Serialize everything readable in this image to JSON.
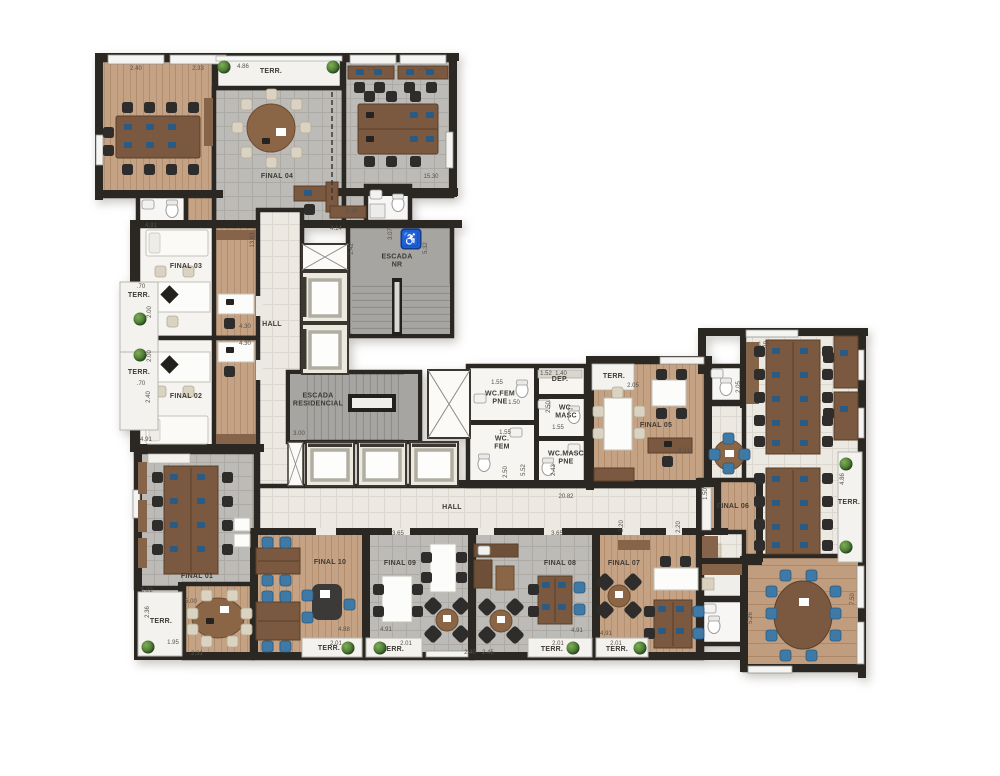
{
  "floor_plan": {
    "colors": {
      "wall": "#2b2824",
      "wood_floor": "#c4a283",
      "stone_floor": "#bdbbb7",
      "hall_floor": "#ebe9e2",
      "stair_floor": "#a6a5a2",
      "terrace_floor": "#f3f2ee",
      "desk_wood": "#7b5941",
      "chair_dark": "#2e2d2c",
      "chair_blue": "#3f79a5",
      "chair_beige": "#dbd3c2",
      "accessibility_blue": "#1d5ed2"
    },
    "accessibility_icon": {
      "symbol": "♿",
      "x": 411,
      "y": 239
    },
    "unit_labels": [
      {
        "id": "terr-top",
        "text": "TERR.",
        "x": 271,
        "y": 72
      },
      {
        "id": "final-04",
        "text": "FINAL 04",
        "x": 277,
        "y": 177
      },
      {
        "id": "final-03",
        "text": "FINAL 03",
        "x": 186,
        "y": 267
      },
      {
        "id": "terr-left-1",
        "text": "TERR.",
        "x": 139,
        "y": 296
      },
      {
        "id": "terr-left-2",
        "text": "TERR.",
        "x": 139,
        "y": 373
      },
      {
        "id": "final-02",
        "text": "FINAL 02",
        "x": 186,
        "y": 397
      },
      {
        "id": "hall-vertical",
        "text": "HALL",
        "x": 272,
        "y": 325
      },
      {
        "id": "escada-nr",
        "text": "ESCADA\nNR",
        "x": 397,
        "y": 262
      },
      {
        "id": "escada-residencial",
        "text": "ESCADA\nRESIDENCIAL",
        "x": 318,
        "y": 401
      },
      {
        "id": "dep",
        "text": "DEP.",
        "x": 560,
        "y": 380
      },
      {
        "id": "wc-fem-pne",
        "text": "WC.FEM\nPNE",
        "x": 500,
        "y": 399
      },
      {
        "id": "wc-masc",
        "text": "WC.\nMASC",
        "x": 566,
        "y": 413
      },
      {
        "id": "wc-fem",
        "text": "WC.\nFEM",
        "x": 502,
        "y": 444
      },
      {
        "id": "wc-masc-pne",
        "text": "WC.MASC\nPNE",
        "x": 566,
        "y": 459
      },
      {
        "id": "terr-05",
        "text": "TERR.",
        "x": 614,
        "y": 377
      },
      {
        "id": "final-05",
        "text": "FINAL 05",
        "x": 656,
        "y": 426
      },
      {
        "id": "hall-horizontal",
        "text": "HALL",
        "x": 452,
        "y": 508
      },
      {
        "id": "final-06",
        "text": "FINAL 06",
        "x": 733,
        "y": 507
      },
      {
        "id": "terr-06",
        "text": "TERR.",
        "x": 849,
        "y": 503
      },
      {
        "id": "final-01",
        "text": "FINAL 01",
        "x": 197,
        "y": 577
      },
      {
        "id": "terr-01",
        "text": "TERR.",
        "x": 161,
        "y": 622
      },
      {
        "id": "final-10",
        "text": "FINAL 10",
        "x": 330,
        "y": 563
      },
      {
        "id": "terr-10",
        "text": "TERR.",
        "x": 329,
        "y": 649
      },
      {
        "id": "final-09",
        "text": "FINAL 09",
        "x": 400,
        "y": 564
      },
      {
        "id": "terr-09",
        "text": "TERR.",
        "x": 393,
        "y": 650
      },
      {
        "id": "final-08",
        "text": "FINAL 08",
        "x": 560,
        "y": 564
      },
      {
        "id": "terr-08",
        "text": "TERR.",
        "x": 552,
        "y": 650
      },
      {
        "id": "final-07",
        "text": "FINAL 07",
        "x": 624,
        "y": 564
      },
      {
        "id": "terr-07",
        "text": "TERR.",
        "x": 617,
        "y": 650
      }
    ],
    "dimensions": [
      {
        "t": "2.40",
        "x": 136,
        "y": 69
      },
      {
        "t": "2.33",
        "x": 198,
        "y": 69
      },
      {
        "t": "4.86",
        "x": 243,
        "y": 67
      },
      {
        "t": "2.51",
        "x": 373,
        "y": 69
      },
      {
        "t": "2.40",
        "x": 424,
        "y": 69
      },
      {
        "t": "15.30",
        "x": 431,
        "y": 177
      },
      {
        "t": "4.91",
        "x": 151,
        "y": 226
      },
      {
        "t": "5.36",
        "x": 352,
        "y": 212
      },
      {
        "t": "4.14",
        "x": 336,
        "y": 229
      },
      {
        "t": "13.63",
        "x": 253,
        "y": 240,
        "v": true
      },
      {
        "t": "1.42",
        "x": 352,
        "y": 249,
        "v": true
      },
      {
        "t": "3.07",
        "x": 391,
        "y": 234,
        "v": true
      },
      {
        "t": "5.32",
        "x": 426,
        "y": 248,
        "v": true
      },
      {
        "t": "4.30",
        "x": 245,
        "y": 327
      },
      {
        "t": "4.30",
        "x": 245,
        "y": 344
      },
      {
        "t": ".70",
        "x": 141,
        "y": 287
      },
      {
        "t": "2.00",
        "x": 150,
        "y": 312,
        "v": true
      },
      {
        "t": "2.00",
        "x": 150,
        "y": 356,
        "v": true
      },
      {
        "t": ".70",
        "x": 141,
        "y": 384
      },
      {
        "t": "2.40",
        "x": 149,
        "y": 397,
        "v": true
      },
      {
        "t": "4.91",
        "x": 146,
        "y": 440
      },
      {
        "t": "3.00",
        "x": 299,
        "y": 434
      },
      {
        "t": "1.55",
        "x": 497,
        "y": 383
      },
      {
        "t": "1.52",
        "x": 546,
        "y": 374
      },
      {
        "t": "1.40",
        "x": 561,
        "y": 374
      },
      {
        "t": "1.50",
        "x": 514,
        "y": 403
      },
      {
        "t": "2.50",
        "x": 549,
        "y": 407,
        "v": true
      },
      {
        "t": "1.55",
        "x": 505,
        "y": 433
      },
      {
        "t": "1.55",
        "x": 558,
        "y": 428
      },
      {
        "t": "2.50",
        "x": 506,
        "y": 472,
        "v": true
      },
      {
        "t": "5.52",
        "x": 524,
        "y": 470,
        "v": true
      },
      {
        "t": "2.43",
        "x": 554,
        "y": 470,
        "v": true
      },
      {
        "t": "20.82",
        "x": 566,
        "y": 497
      },
      {
        "t": "2.05",
        "x": 633,
        "y": 386
      },
      {
        "t": "4.91",
        "x": 684,
        "y": 451
      },
      {
        "t": "1.55",
        "x": 764,
        "y": 345
      },
      {
        "t": "2.05",
        "x": 739,
        "y": 387,
        "v": true
      },
      {
        "t": "4.86",
        "x": 843,
        "y": 479,
        "v": true
      },
      {
        "t": "1.50",
        "x": 706,
        "y": 494,
        "v": true
      },
      {
        "t": "2.20",
        "x": 622,
        "y": 526,
        "v": true
      },
      {
        "t": "2.20",
        "x": 679,
        "y": 527,
        "v": true
      },
      {
        "t": "3.65",
        "x": 398,
        "y": 534
      },
      {
        "t": "3.65",
        "x": 557,
        "y": 534
      },
      {
        "t": "5.22",
        "x": 147,
        "y": 591
      },
      {
        "t": "5.00",
        "x": 191,
        "y": 602
      },
      {
        "t": "2.36",
        "x": 148,
        "y": 612,
        "v": true
      },
      {
        "t": "1.95",
        "x": 173,
        "y": 643
      },
      {
        "t": "2.31",
        "x": 197,
        "y": 654
      },
      {
        "t": "4.88",
        "x": 344,
        "y": 630
      },
      {
        "t": "2.01",
        "x": 336,
        "y": 644
      },
      {
        "t": "2.01",
        "x": 406,
        "y": 644
      },
      {
        "t": "4.91",
        "x": 386,
        "y": 630
      },
      {
        "t": "2.40",
        "x": 470,
        "y": 653
      },
      {
        "t": "2.45",
        "x": 488,
        "y": 653
      },
      {
        "t": "2.01",
        "x": 558,
        "y": 644
      },
      {
        "t": "4.91",
        "x": 577,
        "y": 631
      },
      {
        "t": "2.01",
        "x": 616,
        "y": 644
      },
      {
        "t": "4.91",
        "x": 606,
        "y": 634
      },
      {
        "t": "5.26",
        "x": 751,
        "y": 618,
        "v": true
      },
      {
        "t": "7.50",
        "x": 853,
        "y": 599,
        "v": true
      }
    ],
    "plants": [
      {
        "x": 224,
        "y": 67
      },
      {
        "x": 333,
        "y": 67
      },
      {
        "x": 140,
        "y": 319
      },
      {
        "x": 140,
        "y": 355
      },
      {
        "x": 846,
        "y": 464
      },
      {
        "x": 846,
        "y": 547
      },
      {
        "x": 148,
        "y": 647
      },
      {
        "x": 348,
        "y": 648
      },
      {
        "x": 380,
        "y": 648
      },
      {
        "x": 573,
        "y": 648
      },
      {
        "x": 640,
        "y": 648
      }
    ]
  }
}
